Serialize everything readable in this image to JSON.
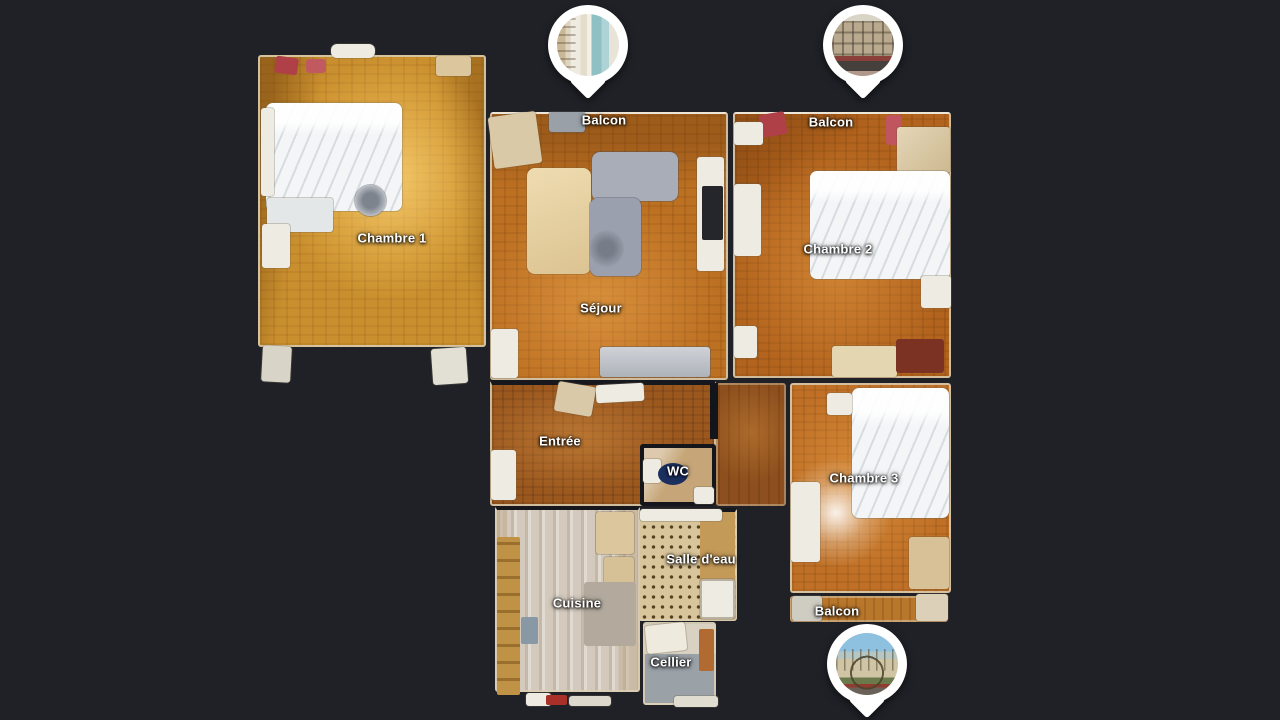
{
  "app": {
    "view": "floorplan-top-down",
    "background_color": "#1f2127",
    "label_text_color": "#ffffff",
    "pin_color": "#ffffff"
  },
  "rooms": {
    "chambre1": {
      "label": "Chambre 1"
    },
    "sejour": {
      "label": "Séjour"
    },
    "chambre2": {
      "label": "Chambre 2"
    },
    "chambre3": {
      "label": "Chambre 3"
    },
    "entree": {
      "label": "Entrée"
    },
    "wc": {
      "label": "WC"
    },
    "salle_deau": {
      "label": "Salle d'eau"
    },
    "cuisine": {
      "label": "Cuisine"
    },
    "cellier": {
      "label": "Cellier"
    },
    "balcon_sejour": {
      "label": "Balcon"
    },
    "balcon_chambre2": {
      "label": "Balcon"
    },
    "balcon_chambre3": {
      "label": "Balcon"
    }
  },
  "pins": [
    {
      "id": "pin-top-left",
      "photo_subject": "window-shutters-teal-curtain"
    },
    {
      "id": "pin-top-right",
      "photo_subject": "building-facade"
    },
    {
      "id": "pin-bottom-right",
      "photo_subject": "glass-conservatory-dome"
    }
  ],
  "floor_colors": {
    "bedroom_gold": "#c98f2e",
    "living_orange": "#bc7022",
    "hall_brown": "#9a571e",
    "kitchen_light": "#d3cabd",
    "bathroom_spotted": "#d9c59b",
    "cellar_gray": "#9aa1a7"
  }
}
